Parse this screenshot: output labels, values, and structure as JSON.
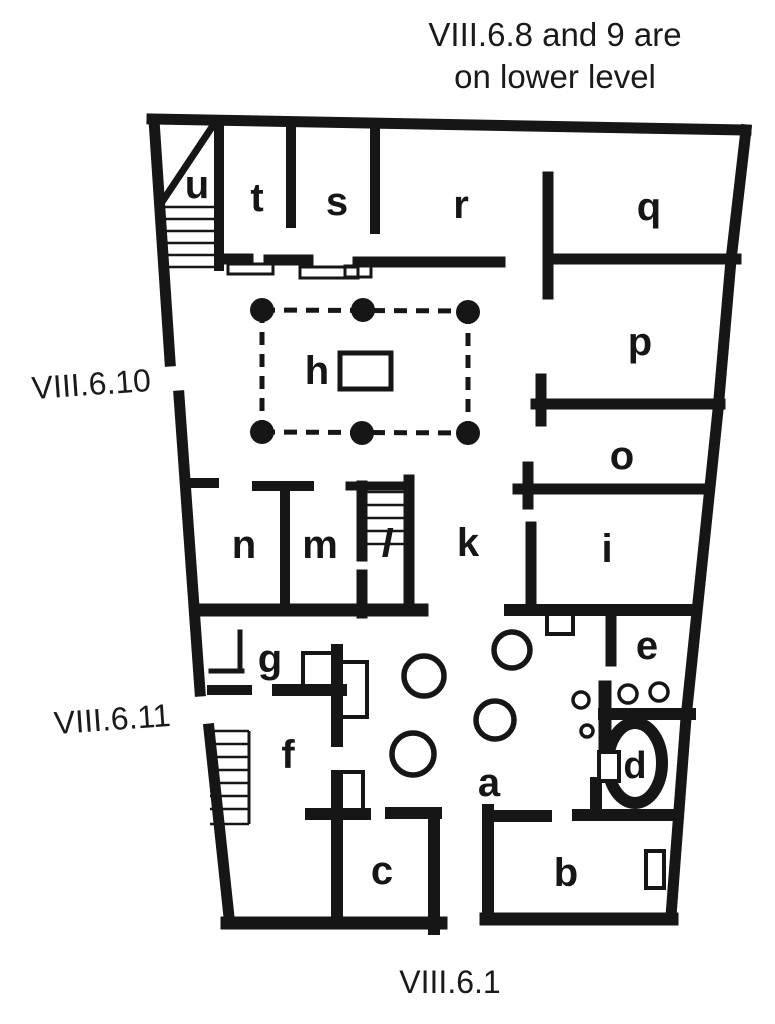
{
  "title": {
    "line1": "VIII.6.8 and 9 are",
    "line2": "on lower level"
  },
  "street_labels": [
    {
      "name": "street-label-viii-6-10",
      "text": "VIII.6.10",
      "x": 92,
      "y": 395,
      "rotate": -4
    },
    {
      "name": "street-label-viii-6-11",
      "text": "VIII.6.11",
      "x": 113,
      "y": 730,
      "rotate": -4
    },
    {
      "name": "street-label-viii-6-1",
      "text": "VIII.6.1",
      "x": 450,
      "y": 993,
      "rotate": 0
    }
  ],
  "room_labels": [
    {
      "name": "room-label-u",
      "text": "u",
      "x": 197,
      "y": 198
    },
    {
      "name": "room-label-t",
      "text": "t",
      "x": 257,
      "y": 211
    },
    {
      "name": "room-label-s",
      "text": "s",
      "x": 337,
      "y": 215
    },
    {
      "name": "room-label-r",
      "text": "r",
      "x": 461,
      "y": 218
    },
    {
      "name": "room-label-q",
      "text": "q",
      "x": 649,
      "y": 220
    },
    {
      "name": "room-label-p",
      "text": "p",
      "x": 640,
      "y": 355
    },
    {
      "name": "room-label-o",
      "text": "o",
      "x": 622,
      "y": 469
    },
    {
      "name": "room-label-i",
      "text": "i",
      "x": 607,
      "y": 562
    },
    {
      "name": "room-label-e",
      "text": "e",
      "x": 647,
      "y": 659
    },
    {
      "name": "room-label-k",
      "text": "k",
      "x": 468,
      "y": 556
    },
    {
      "name": "room-label-n",
      "text": "n",
      "x": 244,
      "y": 558
    },
    {
      "name": "room-label-m",
      "text": "m",
      "x": 320,
      "y": 558
    },
    {
      "name": "room-label-l",
      "text": "l",
      "x": 387,
      "y": 557,
      "italic": true
    },
    {
      "name": "room-label-h",
      "text": "h",
      "x": 317,
      "y": 384
    },
    {
      "name": "room-label-g",
      "text": "g",
      "x": 270,
      "y": 672
    },
    {
      "name": "room-label-f",
      "text": "f",
      "x": 288,
      "y": 768
    },
    {
      "name": "room-label-a",
      "text": "a",
      "x": 489,
      "y": 796
    },
    {
      "name": "room-label-b",
      "text": "b",
      "x": 566,
      "y": 886
    },
    {
      "name": "room-label-c",
      "text": "c",
      "x": 382,
      "y": 884
    },
    {
      "name": "room-label-d",
      "text": "d",
      "x": 635,
      "y": 778,
      "size": 38
    }
  ],
  "plan": {
    "ink": "#161616",
    "background": "#ffffff",
    "walls": [
      [
        152,
        119,
        746,
        130,
        11
      ],
      [
        154,
        120,
        170,
        361,
        11
      ],
      [
        179,
        396,
        200,
        691,
        11
      ],
      [
        209,
        729,
        229,
        917,
        11
      ],
      [
        227,
        923,
        441,
        923,
        13
      ],
      [
        486,
        919,
        672,
        919,
        13
      ],
      [
        219,
        121,
        219,
        266,
        10
      ],
      [
        216,
        121,
        164,
        199,
        7
      ],
      [
        291,
        129,
        291,
        223,
        10
      ],
      [
        375,
        127,
        375,
        229,
        10
      ],
      [
        548,
        177,
        548,
        294,
        11
      ],
      [
        548,
        259,
        736,
        259,
        11
      ],
      [
        221,
        259,
        248,
        259,
        11
      ],
      [
        269,
        260,
        308,
        260,
        11
      ],
      [
        358,
        262,
        500,
        262,
        11
      ],
      [
        185,
        483,
        214,
        483,
        10
      ],
      [
        257,
        486,
        309,
        486,
        10
      ],
      [
        285,
        486,
        285,
        608,
        10
      ],
      [
        362,
        486,
        362,
        556,
        11
      ],
      [
        350,
        486,
        409,
        486,
        9
      ],
      [
        409,
        480,
        409,
        610,
        11
      ],
      [
        362,
        575,
        362,
        613,
        11
      ],
      [
        199,
        610,
        422,
        610,
        13
      ],
      [
        541,
        379,
        541,
        421,
        11
      ],
      [
        536,
        404,
        720,
        404,
        11
      ],
      [
        528,
        467,
        528,
        504,
        11
      ],
      [
        518,
        489,
        707,
        489,
        11
      ],
      [
        531,
        527,
        531,
        609,
        11
      ],
      [
        510,
        610,
        696,
        610,
        12
      ],
      [
        611,
        611,
        611,
        661,
        11
      ],
      [
        605,
        687,
        605,
        754,
        13
      ],
      [
        604,
        714,
        690,
        714,
        12
      ],
      [
        596,
        783,
        596,
        814,
        12
      ],
      [
        488,
        810,
        488,
        919,
        12
      ],
      [
        488,
        816,
        546,
        816,
        12
      ],
      [
        578,
        815,
        677,
        815,
        12
      ],
      [
        337,
        776,
        337,
        922,
        12
      ],
      [
        311,
        814,
        365,
        814,
        12
      ],
      [
        391,
        813,
        436,
        813,
        12
      ],
      [
        434,
        813,
        434,
        929,
        12
      ],
      [
        337,
        650,
        337,
        741,
        12
      ],
      [
        278,
        690,
        341,
        690,
        12
      ],
      [
        212,
        690,
        247,
        690,
        10
      ],
      [
        240,
        632,
        240,
        670,
        5
      ],
      [
        211,
        671,
        242,
        671,
        5
      ]
    ],
    "right_wall_points": "746,130 731,260 718,410 697,612 686,718 671,916",
    "right_wall_width": 11,
    "colonnade": {
      "dash": "13 9",
      "width": 5,
      "lines": [
        [
          262,
          310,
          468,
          311
        ],
        [
          262,
          432,
          468,
          433
        ],
        [
          262,
          310,
          262,
          432
        ],
        [
          468,
          311,
          468,
          433
        ]
      ],
      "columns": [
        [
          262,
          310
        ],
        [
          363,
          310
        ],
        [
          468,
          312
        ],
        [
          262,
          432
        ],
        [
          362,
          433
        ],
        [
          468,
          433
        ]
      ],
      "column_r": 12
    },
    "impluvium": {
      "x": 340,
      "y": 353,
      "w": 51,
      "h": 36,
      "sw": 5
    },
    "thin_rects": [
      {
        "name": "threshold-t",
        "x": 228,
        "y": 264,
        "w": 45,
        "h": 10,
        "sw": 3
      },
      {
        "name": "threshold-s",
        "x": 300,
        "y": 267,
        "w": 58,
        "h": 11,
        "sw": 3
      },
      {
        "name": "threshold-r",
        "x": 345,
        "y": 266,
        "w": 26,
        "h": 11,
        "sw": 3
      },
      {
        "name": "basin-feature",
        "x": 547,
        "y": 613,
        "w": 26,
        "h": 21,
        "sw": 4
      },
      {
        "name": "room-g-feature-1",
        "x": 303,
        "y": 653,
        "w": 30,
        "h": 34,
        "sw": 4
      },
      {
        "name": "room-g-feature-2",
        "x": 340,
        "y": 662,
        "w": 27,
        "h": 55,
        "sw": 4
      },
      {
        "name": "room-c-feature",
        "x": 334,
        "y": 772,
        "w": 29,
        "h": 46,
        "sw": 4
      }
    ],
    "door_rects": [
      {
        "name": "room-b-door",
        "x": 646,
        "y": 851,
        "w": 18,
        "h": 37,
        "sw": 4
      },
      {
        "name": "room-d-door",
        "x": 599,
        "y": 752,
        "w": 20,
        "h": 29,
        "sw": 4
      }
    ],
    "stairs": [
      {
        "name": "stairs-u",
        "x1": 161,
        "x2": 219,
        "ys": [
          207,
          219,
          231,
          243,
          255,
          267
        ],
        "sw": 2.5
      },
      {
        "name": "stairs-l",
        "x1": 366,
        "x2": 407,
        "ys": [
          492,
          505,
          518,
          531,
          544
        ],
        "sw": 2.5
      },
      {
        "name": "stairs-f",
        "x1": 210,
        "x2": 249,
        "ys": [
          731,
          744,
          757,
          770,
          783,
          796,
          809,
          824
        ],
        "sw": 2.5,
        "edge": [
          249,
          731,
          249,
          824
        ]
      }
    ],
    "dolia": [
      [
        424,
        676,
        20
      ],
      [
        413,
        754,
        21
      ],
      [
        512,
        650,
        18
      ],
      [
        495,
        720,
        19
      ]
    ],
    "dolia_sw": 5.5,
    "small_circles": [
      [
        581,
        700,
        8
      ],
      [
        628,
        694,
        9
      ],
      [
        659,
        692,
        9
      ],
      [
        587,
        731,
        6
      ]
    ],
    "small_circles_sw": 3.5,
    "oven": {
      "cx": 635,
      "cy": 763,
      "rx": 27,
      "ry": 40,
      "sw": 12
    }
  }
}
